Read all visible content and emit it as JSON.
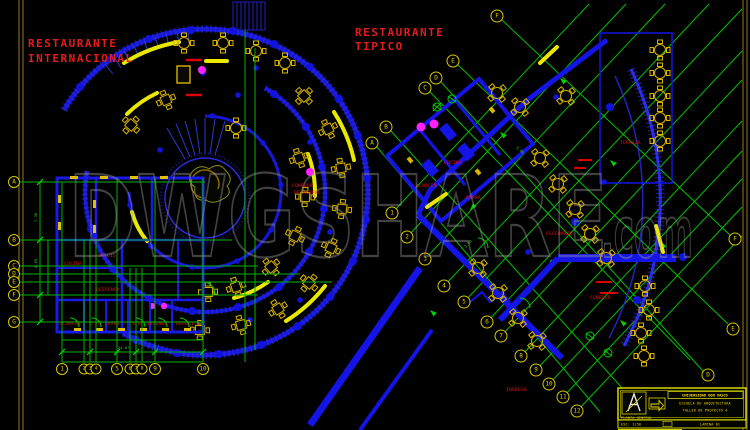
{
  "sheet": {
    "watermark_main": "DWGSHARE",
    "watermark_suffix": ".com"
  },
  "left_plan": {
    "title_line1": "RESTAURANTE",
    "title_line2": "INTERNACIONAL",
    "grid_letters": [
      "A",
      "B",
      "C",
      "D",
      "E",
      "F",
      "G"
    ],
    "grid_numbers": [
      "1",
      "2",
      "3",
      "4",
      "5",
      "6",
      "7",
      "8",
      "9",
      "10"
    ],
    "room_labels": [
      "COCINA",
      "OFICIO",
      "DESPENSA",
      "ALMACEN",
      "S.H. DAMAS",
      "S.H. VARONES",
      "DEPOSITO",
      "COMEDOR",
      "PRINCIPAL"
    ],
    "dims": [
      "24.67",
      "7.38",
      "4.05"
    ]
  },
  "right_plan": {
    "title_line1": "RESTAURANTE",
    "title_line2": "TIPICO",
    "grid_letters": [
      "A",
      "B",
      "C",
      "D",
      "E",
      "F"
    ],
    "grid_numbers": [
      "1",
      "2",
      "3",
      "4",
      "5",
      "6",
      "7",
      "8",
      "9",
      "10",
      "11",
      "12"
    ],
    "room_labels": [
      "COCINA",
      "BARRA",
      "ALMACEN",
      "COMEDOR",
      "TERRAZA",
      "INGRESO",
      "ESCENARIO"
    ],
    "dims": [
      "3.00",
      "2.50"
    ]
  },
  "title_block": {
    "line1": "UNIVERSIDAD DON VASCO",
    "line2": "ESCUELA DE ARQUITECTURA",
    "line3": "TALLER DE PROYECTO 4",
    "scale": "ESC: 1/50",
    "sheet_no": "LAMINA 01",
    "bottom": "PLANTA GENERAL"
  },
  "colors": {
    "background": "#000000",
    "wall_blue": "#1717d8",
    "grid_green": "#00c000",
    "furniture_yellow": "#d8b400",
    "bench_yellow": "#e8e800",
    "label_red": "#e01212",
    "accent_magenta": "#ff22ff",
    "watermark_gray": "#9b9b9b",
    "border_olive": "#7a6420"
  }
}
